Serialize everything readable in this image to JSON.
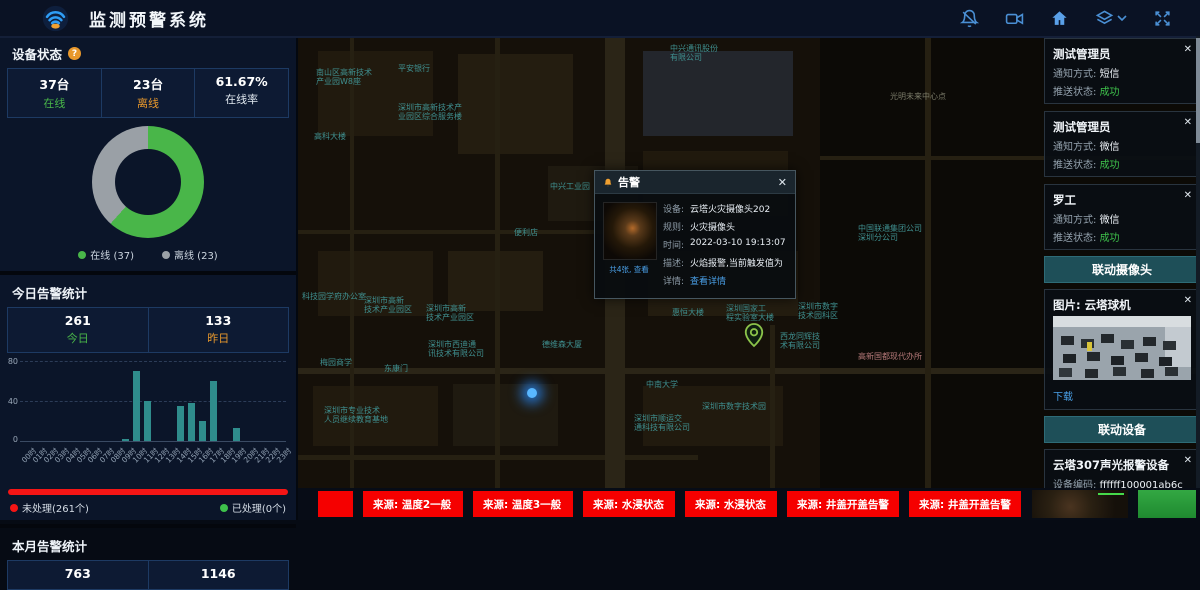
{
  "ui": {
    "close_glyph": "✕"
  },
  "header": {
    "title": "监测预警系统",
    "icons": [
      "bell-off-icon",
      "video-camera-icon",
      "home-icon",
      "layers-icon",
      "chevron-down-icon",
      "fullscreen-icon"
    ],
    "icon_color": "#4a8fd4",
    "home_color": "#5aa0e8"
  },
  "left_panel": {
    "device_status": {
      "title": "设备状态",
      "help_glyph": "?",
      "stats": [
        {
          "value": "37台",
          "label": "在线",
          "cls": "green"
        },
        {
          "value": "23台",
          "label": "离线",
          "cls": "orange"
        },
        {
          "value": "61.67%",
          "label": "在线率",
          "cls": "white"
        }
      ],
      "legend": [
        {
          "label": "在线 (37)",
          "color": "#49b649"
        },
        {
          "label": "离线 (23)",
          "color": "#9aa0a6"
        }
      ],
      "chart_data": {
        "type": "pie",
        "labels": [
          "在线",
          "离线"
        ],
        "values": [
          37,
          23
        ],
        "colors": [
          "#49b649",
          "#9aa0a6"
        ],
        "online_pct": 61.67
      }
    },
    "today_alerts": {
      "title": "今日告警统计",
      "stats": [
        {
          "value": "261",
          "label": "今日",
          "cls": "green"
        },
        {
          "value": "133",
          "label": "昨日",
          "cls": "orange"
        }
      ],
      "chart_data": {
        "type": "bar",
        "categories": [
          "00时",
          "01时",
          "02时",
          "03时",
          "04时",
          "05时",
          "06时",
          "07时",
          "08时",
          "09时",
          "10时",
          "11时",
          "12时",
          "13时",
          "14时",
          "15时",
          "16时",
          "17时",
          "18时",
          "19时",
          "20时",
          "21时",
          "22时",
          "23时"
        ],
        "values": [
          0,
          0,
          0,
          0,
          0,
          0,
          0,
          0,
          0,
          2,
          70,
          40,
          0,
          0,
          35,
          38,
          20,
          60,
          0,
          13,
          0,
          0,
          0,
          0
        ],
        "ylim": [
          0,
          80
        ],
        "yticks": [
          0,
          40,
          80
        ],
        "bar_color": "#2f8c8c",
        "grid": "dashed"
      },
      "unhandled_label": "未处理(261个)",
      "unhandled_color": "#f51515",
      "handled_label": "已处理(0个)",
      "handled_color": "#3ec14b",
      "unhandled_pct": 100
    },
    "month_alerts": {
      "title": "本月告警统计",
      "stats": [
        {
          "value": "763",
          "label": "",
          "cls": "white"
        },
        {
          "value": "1146",
          "label": "",
          "cls": "white"
        }
      ]
    }
  },
  "map": {
    "labels": [
      {
        "t": "中兴通讯股份\n有限公司",
        "x": 372,
        "y": 8
      },
      {
        "t": "南山区高新技术\n产业园W8座",
        "x": 18,
        "y": 32
      },
      {
        "t": "平安银行",
        "x": 100,
        "y": 28
      },
      {
        "t": "光明未来中心点",
        "x": 592,
        "y": 56,
        "c": "#7a7a68"
      },
      {
        "t": "深圳市高新技术产\n业园区综合服务楼",
        "x": 100,
        "y": 67
      },
      {
        "t": "高科大楼",
        "x": 16,
        "y": 96
      },
      {
        "t": "中兴工业园",
        "x": 252,
        "y": 146
      },
      {
        "t": "便利店",
        "x": 216,
        "y": 192
      },
      {
        "t": "中国联通集团公司\n深圳分公司",
        "x": 560,
        "y": 188
      },
      {
        "t": "科技园学府办公室",
        "x": 4,
        "y": 256
      },
      {
        "t": "深圳市高新\n技术产业园区",
        "x": 66,
        "y": 260
      },
      {
        "t": "深圳市高新\n技术产业园区",
        "x": 128,
        "y": 268
      },
      {
        "t": "深圳市西迪通\n讯技术有限公司",
        "x": 130,
        "y": 304
      },
      {
        "t": "德维森大厦",
        "x": 244,
        "y": 304
      },
      {
        "t": "惠恒大楼",
        "x": 374,
        "y": 272
      },
      {
        "t": "深圳国家工\n程实验室大楼",
        "x": 428,
        "y": 268
      },
      {
        "t": "深圳市数字\n技术园科区",
        "x": 500,
        "y": 266
      },
      {
        "t": "西龙同辉技\n术有限公司",
        "x": 482,
        "y": 296
      },
      {
        "t": "高新国都现代办所",
        "x": 560,
        "y": 316,
        "c": "#b77a7a"
      },
      {
        "t": "梅园商学",
        "x": 22,
        "y": 322
      },
      {
        "t": "东康门",
        "x": 86,
        "y": 328
      },
      {
        "t": "中南大学",
        "x": 348,
        "y": 344
      },
      {
        "t": "深圳市专业技术\n人员继续教育基地",
        "x": 26,
        "y": 370
      },
      {
        "t": "深圳市数字技术园",
        "x": 404,
        "y": 366
      },
      {
        "t": "深圳市顺运交\n通科技有限公司",
        "x": 336,
        "y": 378
      }
    ],
    "popup": {
      "title": "告警",
      "thumbnail_caption": "共4张, 查看",
      "fields": [
        {
          "label": "设备:",
          "value": "云塔火灾摄像头202",
          "cls": ""
        },
        {
          "label": "规则:",
          "value": "火灾摄像头",
          "cls": ""
        },
        {
          "label": "时间:",
          "value": "2022-03-10 19:13:07",
          "cls": ""
        },
        {
          "label": "描述:",
          "value": "火焰报警,当前触发值为",
          "cls": ""
        },
        {
          "label": "详情:",
          "value": "查看详情",
          "cls": "link"
        }
      ]
    }
  },
  "right_panel": {
    "alert_cards": [
      {
        "title": "测试管理员",
        "fields": [
          {
            "label": "通知方式: ",
            "value": "短信",
            "cls": ""
          },
          {
            "label": "推送状态: ",
            "value": "成功",
            "cls": "ok"
          }
        ]
      },
      {
        "title": "测试管理员",
        "fields": [
          {
            "label": "通知方式: ",
            "value": "微信",
            "cls": ""
          },
          {
            "label": "推送状态: ",
            "value": "成功",
            "cls": "ok"
          }
        ]
      },
      {
        "title": "罗工",
        "fields": [
          {
            "label": "通知方式: ",
            "value": "微信",
            "cls": ""
          },
          {
            "label": "推送状态: ",
            "value": "成功",
            "cls": "ok"
          }
        ]
      }
    ],
    "camera_section": {
      "header": "联动摄像头",
      "card_title": "图片: 云塔球机",
      "download_label": "下载"
    },
    "device_section": {
      "header": "联动设备",
      "cards": [
        {
          "title": "云塔307声光报警设备",
          "fields": [
            {
              "label": "设备编码: ",
              "value": "ffffff100001ab6c",
              "cls": ""
            },
            {
              "label": "调用服务: ",
              "value": "报警",
              "cls": ""
            },
            {
              "label": "下发结果: ",
              "value": "成功",
              "cls": "ok"
            }
          ]
        },
        {
          "title": "SIP壁挂音箱1105",
          "fields": [
            {
              "label": "设备编码: ",
              "value": "1106",
              "cls": ""
            }
          ]
        }
      ]
    }
  },
  "bottom_bar": {
    "chips": [
      {
        "label": "",
        "w": 35
      },
      {
        "label": "来源: 温度2一般",
        "w": 100
      },
      {
        "label": "来源: 温度3一般",
        "w": 100
      },
      {
        "label": "来源: 水浸状态",
        "w": 92
      },
      {
        "label": "来源: 水浸状态",
        "w": 92
      },
      {
        "label": "来源: 井盖开盖告警",
        "w": 112
      },
      {
        "label": "来源: 井盖开盖告警",
        "w": 112
      }
    ]
  }
}
